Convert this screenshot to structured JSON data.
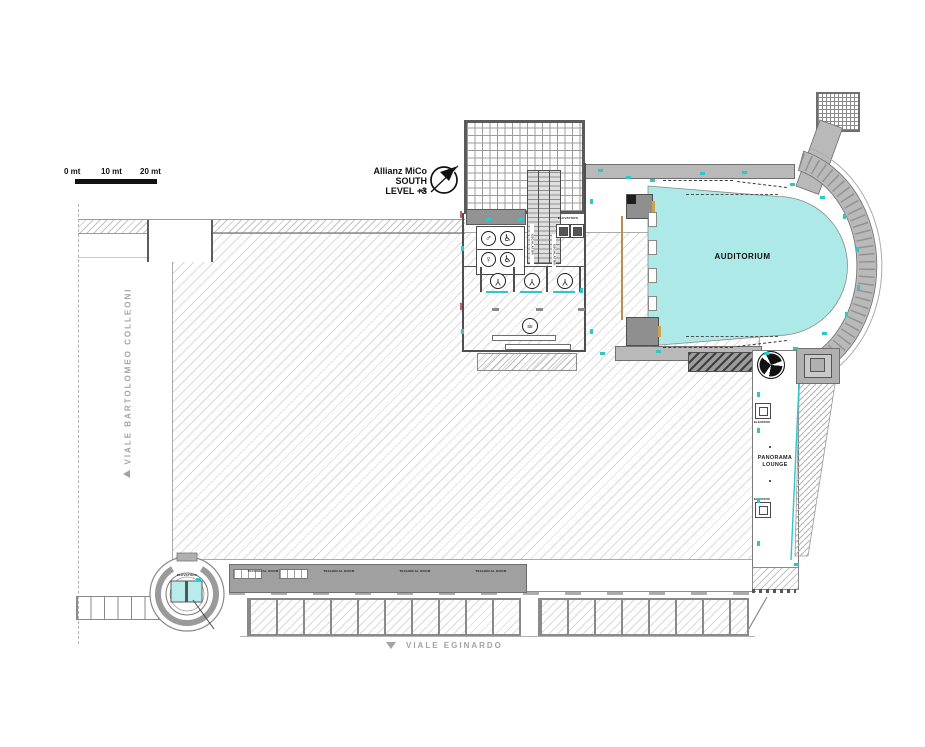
{
  "scale_bar": {
    "marks": [
      "0 mt",
      "10 mt",
      "20 mt"
    ]
  },
  "title": {
    "lines": [
      "Allianz MiCo",
      "SOUTH",
      "LEVEL +3"
    ]
  },
  "compass": {
    "north": "N"
  },
  "rooms": {
    "auditorium": "AUDITORIUM",
    "panorama_lounge": "PANORAMA LOUNGE"
  },
  "labels": {
    "elevator": "ELEVATOR",
    "elevators": "ELEVATORS",
    "escalator": "ESCALATOR",
    "technical_room": "TECHNICAL ROOM"
  },
  "streets": {
    "west": "VIALE BARTOLOMEO COLLEONI",
    "south": "VIALE EGINARDO"
  },
  "icons": {
    "male": "♂",
    "female": "♀",
    "wheelchair": "♿",
    "cloakroom": "Y",
    "cafe": "☕"
  },
  "colors": {
    "auditorium_fill": "#ace9e7",
    "accent_cyan": "#2fc5c9",
    "wall_gray": "#5f5f5f",
    "band_gray": "#b9b9b9",
    "street_text": "#a3a3a3"
  }
}
